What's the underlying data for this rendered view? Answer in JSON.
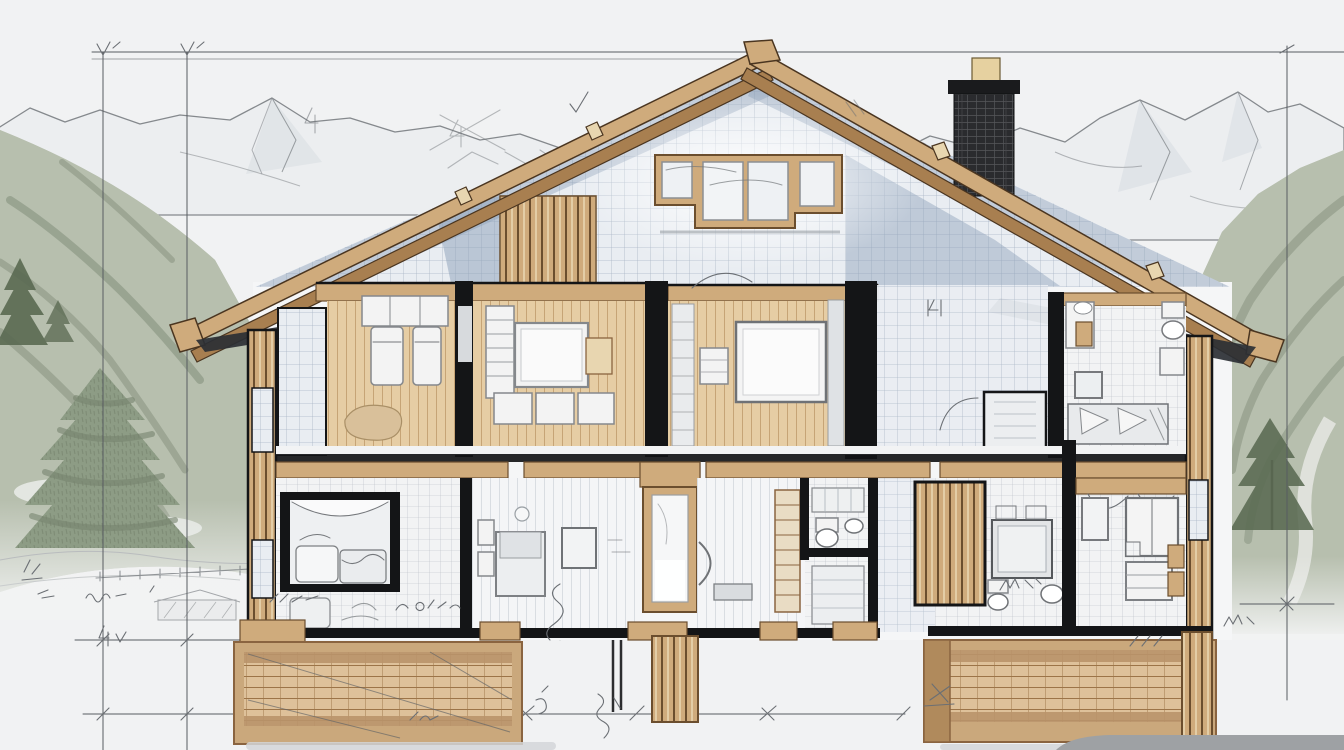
{
  "meta": {
    "title": "Chalet concept drawing — cross-section floor plan sketched over an alpine landscape",
    "drawing_type": "architectural-sketch",
    "visible_text": "none (only illegible handwritten pencil scribbles and dimension marks)"
  },
  "colors": {
    "sky": "#f1f2f3",
    "pencil": "#6b6f74",
    "dim": "#585c61",
    "ink": "#141517",
    "mountain_line": "#85898d",
    "mountain_fill": "#eceef0",
    "mountain_shade": "#dde1e6",
    "forest": "#b7bfae",
    "forest_dark": "#76836e",
    "forest_deep": "#5a6a52",
    "snow": "#f2f3f3",
    "wood_light": "#e8d6b0",
    "wood": "#cfab7c",
    "wood_dark": "#a87f50",
    "wood_deep": "#6b4e2e",
    "graph_bg": "#e9edf2",
    "graph_line": "#a9b6c6",
    "gable_shade": "#8ca0b8",
    "floor_wood": "#e6cda4",
    "floor_line": "#c19d6f",
    "pale_floor": "#f4f5f7",
    "pale_line": "#d9dde2",
    "tile": "#f2f3f4",
    "tile_line": "#aab2ba",
    "furniture": "#f3f3f3",
    "furniture_edge": "#85888c",
    "shadow": "#2b2f34",
    "chimney": "#2a2b2e",
    "chimney_line": "#55565a",
    "chimney_cap": "#1a1b1d",
    "knob": "#e6d1a0",
    "ground_shadow": "#d4d6d8",
    "mound": "#9ea1a4",
    "foundation_wood": "#dec19a",
    "foundation_line": "#9c7448",
    "frame_wood": "#caa87c"
  },
  "scene": {
    "background": {
      "elements": [
        "mountain-range-left",
        "mountain-range-right",
        "forest-hillside-left",
        "forest-hillside-right",
        "pine-trees-left",
        "pine-tree-right",
        "snow-ground",
        "fence-sketch",
        "shed-sketch"
      ]
    },
    "house": {
      "elements": [
        "gable-roof",
        "roof-beam-joints",
        "chimney-with-cap",
        "attic-window",
        "gable-grid-wall",
        "wood-slat-panel",
        "timber-side-walls",
        "foundation-cribs",
        "timber-posts"
      ]
    },
    "floor_plan": {
      "upper_rooms": [
        {
          "id": "bedroom-left",
          "floor": "wood-plank",
          "furniture": [
            "wardrobe-row",
            "bed",
            "bed",
            "round-rug"
          ]
        },
        {
          "id": "bedroom-center",
          "floor": "wood-plank",
          "furniture": [
            "closet-column",
            "double-bed-with-headboard",
            "dresser-row-of-three"
          ]
        },
        {
          "id": "master-bedroom",
          "floor": "wood-plank",
          "furniture": [
            "wall-closet",
            "large-double-bed",
            "side-shelf",
            "door-swing"
          ]
        },
        {
          "id": "landing-corridor",
          "floor": "graph-grid",
          "furniture": [
            "door-swing",
            "shower-box"
          ]
        },
        {
          "id": "bedroom-right",
          "floor": "tile",
          "furniture": [
            "vanity-mirror",
            "nightstand",
            "wall-art",
            "bed-with-pillows",
            "toilet",
            "wall-cabinet"
          ]
        }
      ],
      "lower_rooms": [
        {
          "id": "bay-lounge",
          "floor": "tile",
          "furniture": [
            "bay-window-sofa",
            "tv-cabinet"
          ]
        },
        {
          "id": "bedroom-lower",
          "floor": "pale-plank",
          "furniture": [
            "bed",
            "nightstands",
            "wall-art",
            "wall-clock"
          ]
        },
        {
          "id": "entry-door",
          "floor": "none",
          "furniture": [
            "framed-door"
          ]
        },
        {
          "id": "hallway",
          "floor": "pale-plank",
          "furniture": [
            "door-handle-arc",
            "bench",
            "cubby-shelf"
          ]
        },
        {
          "id": "bathroom-center",
          "floor": "tile",
          "furniture": [
            "cabinet",
            "toilet",
            "sink"
          ]
        },
        {
          "id": "dining-bath-nook",
          "floor": "tile",
          "furniture": [
            "wardrobe-slat-wall",
            "square-table",
            "toilet",
            "basin"
          ]
        },
        {
          "id": "utility-right",
          "floor": "tile",
          "furniture": [
            "double-door-cabinet",
            "wall-art",
            "drawer-unit",
            "wood-boxes",
            "door-swings"
          ]
        }
      ]
    },
    "annotations": {
      "dimension_lines": [
        "top-horizontal",
        "left-vertical-1",
        "left-vertical-2",
        "right-vertical",
        "bottom-horizontal-left",
        "bottom-horizontal-long",
        "right-ground-tick"
      ],
      "scribble_count": 16,
      "legible": false
    }
  }
}
